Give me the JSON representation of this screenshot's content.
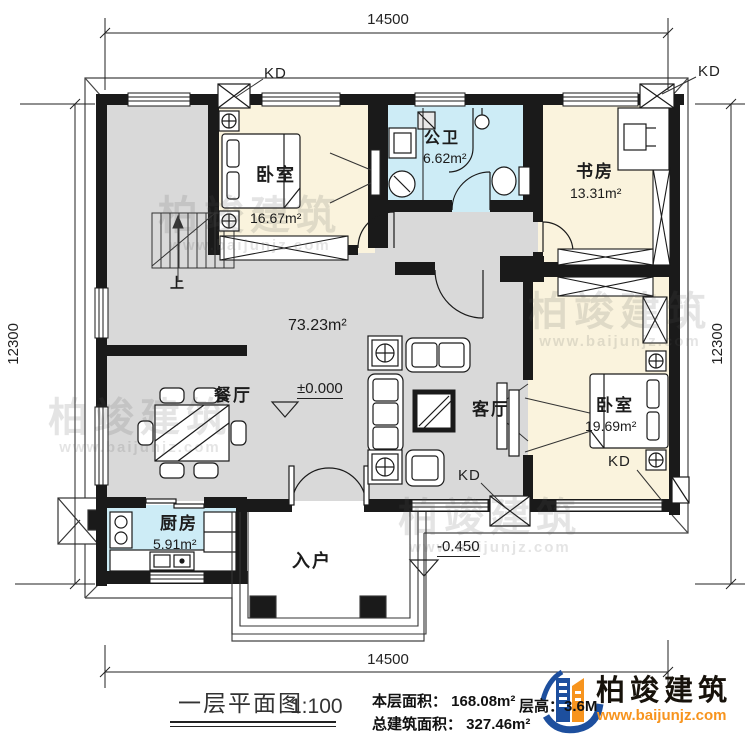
{
  "drawing": {
    "type": "floor-plan",
    "watermark": {
      "text": "柏竣建筑",
      "url": "www.baijunjz.com"
    }
  },
  "dimensions": {
    "top": "14500",
    "bottom": "14500",
    "left": "12300",
    "right": "12300"
  },
  "labels": {
    "kd": "KD",
    "up": "上",
    "hall_area": "73.23m²",
    "level_main": "±0.000",
    "level_porch": "-0.450"
  },
  "rooms": [
    {
      "name": "卧室",
      "area": "16.67m²"
    },
    {
      "name": "公卫",
      "area": "6.62m²"
    },
    {
      "name": "书房",
      "area": "13.31m²"
    },
    {
      "name": "餐厅",
      "area": ""
    },
    {
      "name": "客厅",
      "area": ""
    },
    {
      "name": "卧室",
      "area": "19.69m²"
    },
    {
      "name": "厨房",
      "area": "5.91m²"
    },
    {
      "name": "入户",
      "area": ""
    }
  ],
  "title_block": {
    "title": "一层平面图",
    "scale": "1:100",
    "floor_area": "本层面积： 168.08m²",
    "total_area": "总建筑面积： 327.46m²",
    "storey_height": "层高：3.6M"
  },
  "logo": {
    "name": "柏竣建筑",
    "url": "www.baijunjz.com",
    "blue": "#1d4f9e",
    "orange": "#f7941e"
  },
  "colors": {
    "wall": "#1a1a1a",
    "floor_gray": "#d9d9d9",
    "room_cream": "#faf3dd",
    "room_blue": "#cdecf6"
  }
}
